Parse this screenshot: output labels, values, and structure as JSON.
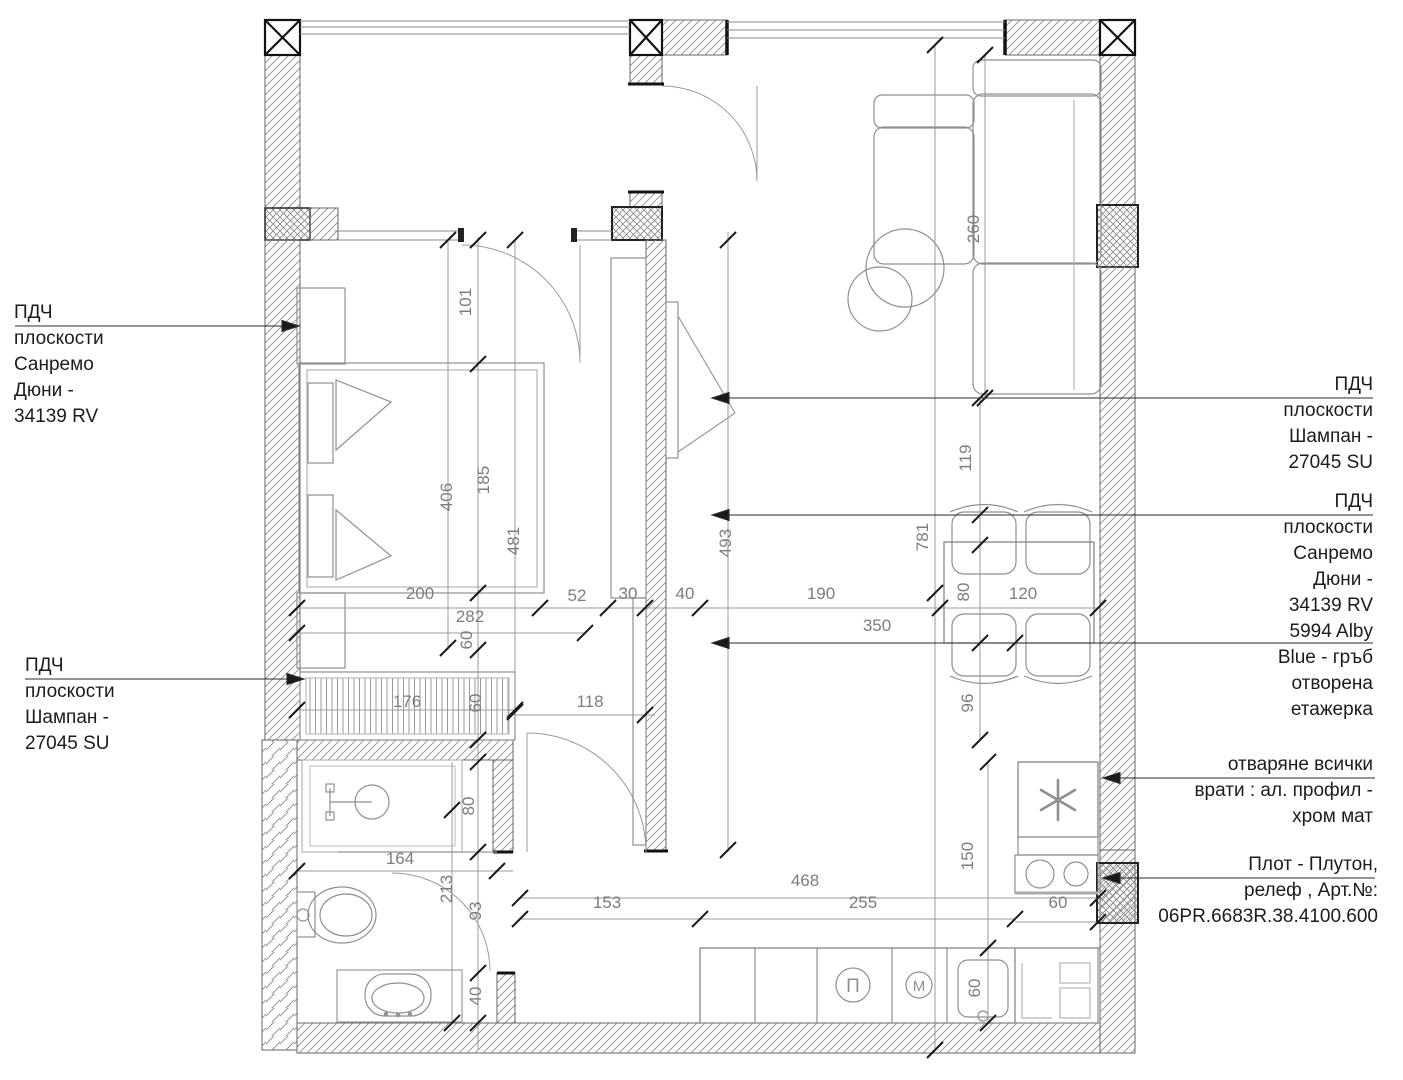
{
  "annotations": {
    "left_top": "ПДЧ\nплоскости\nСанремо\nДюни -\n34139 RV",
    "left_bottom": "ПДЧ\nплоскости\nШампан -\n27045 SU",
    "right_top": "ПДЧ\nплоскости\nШампан -\n27045 SU",
    "right_middle": "ПДЧ\nплоскости\nСанремо\nДюни -\n34139 RV\n5994 Alby\nBlue - гръб\nотворена\nетажерка",
    "right_doors": "отваряне всички\nврати : ал. профил -\nхром мат",
    "right_countertop": "Плот - Плутон,\nрелеф , Арт.№:\n06PR.6683R.38.4100.600"
  },
  "appliances": {
    "oven": "П",
    "washer": "М"
  },
  "dimensions": [
    {
      "text": "101",
      "x": 471,
      "y": 302,
      "rot": -90
    },
    {
      "text": "406",
      "x": 452,
      "y": 497,
      "rot": -90
    },
    {
      "text": "185",
      "x": 489,
      "y": 480,
      "rot": -90
    },
    {
      "text": "481",
      "x": 519,
      "y": 541,
      "rot": -90
    },
    {
      "text": "60",
      "x": 472,
      "y": 640,
      "rot": -90
    },
    {
      "text": "60",
      "x": 481,
      "y": 703,
      "rot": -90
    },
    {
      "text": "493",
      "x": 731,
      "y": 543,
      "rot": -90
    },
    {
      "text": "80",
      "x": 474,
      "y": 806,
      "rot": -90
    },
    {
      "text": "213",
      "x": 452,
      "y": 889,
      "rot": -90
    },
    {
      "text": "93",
      "x": 481,
      "y": 911,
      "rot": -90
    },
    {
      "text": "40",
      "x": 481,
      "y": 996,
      "rot": -90
    },
    {
      "text": "260",
      "x": 979,
      "y": 229,
      "rot": -90
    },
    {
      "text": "119",
      "x": 971,
      "y": 458,
      "rot": -90
    },
    {
      "text": "781",
      "x": 928,
      "y": 537,
      "rot": -90
    },
    {
      "text": "80",
      "x": 969,
      "y": 592,
      "rot": -90
    },
    {
      "text": "96",
      "x": 973,
      "y": 703,
      "rot": -90
    },
    {
      "text": "150",
      "x": 973,
      "y": 856,
      "rot": -90
    },
    {
      "text": "60",
      "x": 980,
      "y": 988,
      "rot": -90
    },
    {
      "text": "200",
      "x": 420,
      "y": 599,
      "rot": 0
    },
    {
      "text": "282",
      "x": 470,
      "y": 622,
      "rot": 0
    },
    {
      "text": "52",
      "x": 577,
      "y": 601,
      "rot": 0
    },
    {
      "text": "30",
      "x": 628,
      "y": 599,
      "rot": 0
    },
    {
      "text": "40",
      "x": 685,
      "y": 599,
      "rot": 0
    },
    {
      "text": "190",
      "x": 821,
      "y": 599,
      "rot": 0
    },
    {
      "text": "350",
      "x": 877,
      "y": 631,
      "rot": 0
    },
    {
      "text": "120",
      "x": 1023,
      "y": 599,
      "rot": 0
    },
    {
      "text": "176",
      "x": 407,
      "y": 707,
      "rot": 0
    },
    {
      "text": "118",
      "x": 590,
      "y": 707,
      "rot": 0
    },
    {
      "text": "164",
      "x": 400,
      "y": 864,
      "rot": 0
    },
    {
      "text": "153",
      "x": 607,
      "y": 908,
      "rot": 0
    },
    {
      "text": "468",
      "x": 805,
      "y": 886,
      "rot": 0
    },
    {
      "text": "255",
      "x": 863,
      "y": 908,
      "rot": 0
    },
    {
      "text": "60",
      "x": 1058,
      "y": 908,
      "rot": 0
    }
  ],
  "colors": {
    "wall_hatch": "#8c8c8c",
    "dim_text": "#7d7d7d",
    "leader": "#2a2a2a"
  }
}
